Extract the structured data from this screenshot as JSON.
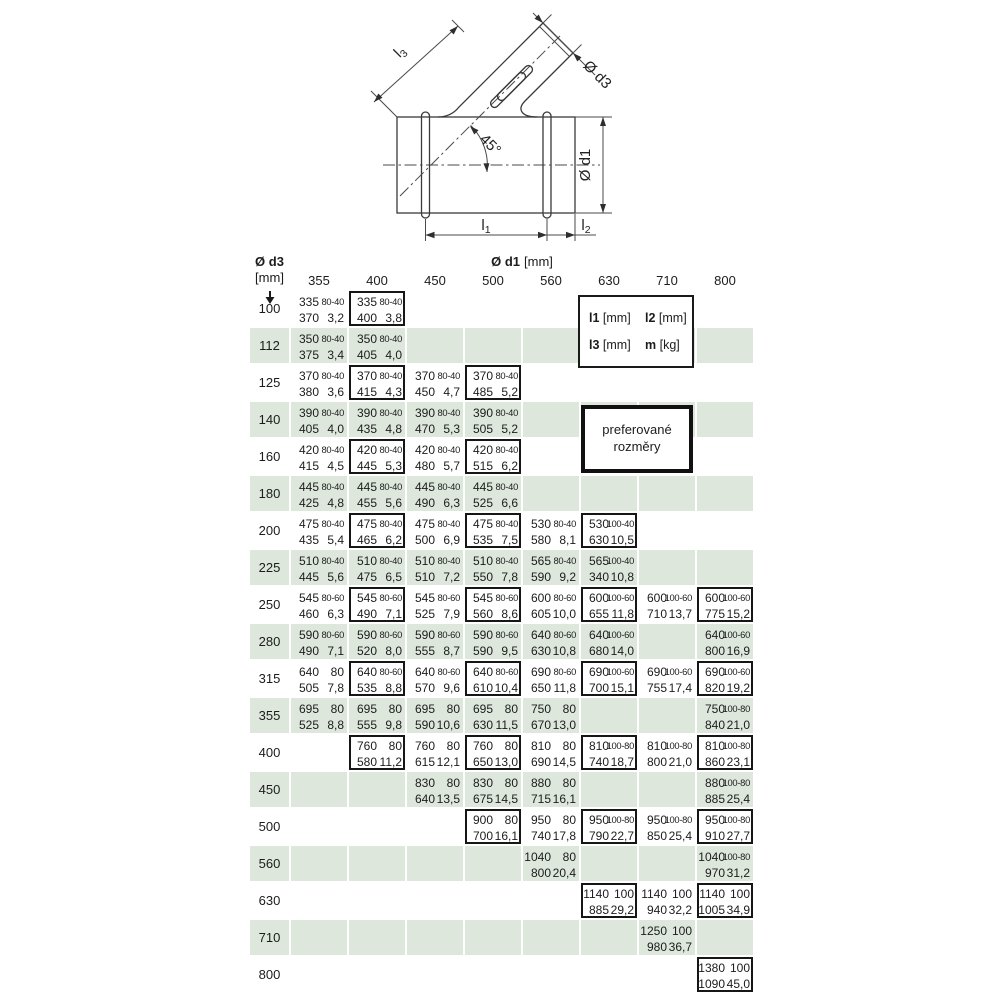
{
  "colors": {
    "row_stripe": "#dde7dc",
    "line": "#3a3a3a",
    "text": "#1c1c1c"
  },
  "drawing": {
    "labels": {
      "l3": {
        "base": "l",
        "sub": "3"
      },
      "d3": "Ø d3",
      "angle": "45°",
      "d1": "Ø d1",
      "l1": {
        "base": "l",
        "sub": "1"
      },
      "l2": {
        "base": "l",
        "sub": "2"
      }
    }
  },
  "table": {
    "corner": {
      "title": "Ø d3",
      "unit": "[mm]"
    },
    "col_header": {
      "title": "Ø d1",
      "unit": "[mm]"
    },
    "columns": [
      "355",
      "400",
      "450",
      "500",
      "560",
      "630",
      "710",
      "800"
    ],
    "legend": {
      "l1": {
        "name": "l1",
        "unit": "[mm]"
      },
      "l2": {
        "name": "l2",
        "unit": "[mm]"
      },
      "l3": {
        "name": "l3",
        "unit": "[mm]"
      },
      "m": {
        "name": "m",
        "unit": "[kg]"
      }
    },
    "preferred_note": {
      "line1": "preferované",
      "line2": "rozměry"
    },
    "rows": [
      {
        "d3": "100",
        "cells": [
          {
            "l1": "335",
            "l2": "80-40",
            "l3": "370",
            "m": "3,2",
            "pref": false
          },
          {
            "l1": "335",
            "l2": "80-40",
            "l3": "400",
            "m": "3,8",
            "pref": true
          },
          null,
          null,
          null,
          null,
          null,
          null
        ]
      },
      {
        "d3": "112",
        "cells": [
          {
            "l1": "350",
            "l2": "80-40",
            "l3": "375",
            "m": "3,4",
            "pref": false
          },
          {
            "l1": "350",
            "l2": "80-40",
            "l3": "405",
            "m": "4,0",
            "pref": false
          },
          null,
          null,
          null,
          null,
          null,
          null
        ]
      },
      {
        "d3": "125",
        "cells": [
          {
            "l1": "370",
            "l2": "80-40",
            "l3": "380",
            "m": "3,6",
            "pref": false
          },
          {
            "l1": "370",
            "l2": "80-40",
            "l3": "415",
            "m": "4,3",
            "pref": true
          },
          {
            "l1": "370",
            "l2": "80-40",
            "l3": "450",
            "m": "4,7",
            "pref": false
          },
          {
            "l1": "370",
            "l2": "80-40",
            "l3": "485",
            "m": "5,2",
            "pref": true
          },
          null,
          null,
          null,
          null
        ]
      },
      {
        "d3": "140",
        "cells": [
          {
            "l1": "390",
            "l2": "80-40",
            "l3": "405",
            "m": "4,0",
            "pref": false
          },
          {
            "l1": "390",
            "l2": "80-40",
            "l3": "435",
            "m": "4,8",
            "pref": false
          },
          {
            "l1": "390",
            "l2": "80-40",
            "l3": "470",
            "m": "5,3",
            "pref": false
          },
          {
            "l1": "390",
            "l2": "80-40",
            "l3": "505",
            "m": "5,2",
            "pref": false
          },
          null,
          null,
          null,
          null
        ]
      },
      {
        "d3": "160",
        "cells": [
          {
            "l1": "420",
            "l2": "80-40",
            "l3": "415",
            "m": "4,5",
            "pref": false
          },
          {
            "l1": "420",
            "l2": "80-40",
            "l3": "445",
            "m": "5,3",
            "pref": true
          },
          {
            "l1": "420",
            "l2": "80-40",
            "l3": "480",
            "m": "5,7",
            "pref": false
          },
          {
            "l1": "420",
            "l2": "80-40",
            "l3": "515",
            "m": "6,2",
            "pref": true
          },
          null,
          null,
          null,
          null
        ]
      },
      {
        "d3": "180",
        "cells": [
          {
            "l1": "445",
            "l2": "80-40",
            "l3": "425",
            "m": "4,8",
            "pref": false
          },
          {
            "l1": "445",
            "l2": "80-40",
            "l3": "455",
            "m": "5,6",
            "pref": false
          },
          {
            "l1": "445",
            "l2": "80-40",
            "l3": "490",
            "m": "6,3",
            "pref": false
          },
          {
            "l1": "445",
            "l2": "80-40",
            "l3": "525",
            "m": "6,6",
            "pref": false
          },
          null,
          null,
          null,
          null
        ]
      },
      {
        "d3": "200",
        "cells": [
          {
            "l1": "475",
            "l2": "80-40",
            "l3": "435",
            "m": "5,4",
            "pref": false
          },
          {
            "l1": "475",
            "l2": "80-40",
            "l3": "465",
            "m": "6,2",
            "pref": true
          },
          {
            "l1": "475",
            "l2": "80-40",
            "l3": "500",
            "m": "6,9",
            "pref": false
          },
          {
            "l1": "475",
            "l2": "80-40",
            "l3": "535",
            "m": "7,5",
            "pref": true
          },
          {
            "l1": "530",
            "l2": "80-40",
            "l3": "580",
            "m": "8,1",
            "pref": false
          },
          {
            "l1": "530",
            "l2": "100-40",
            "l3": "630",
            "m": "10,5",
            "pref": true
          },
          null,
          null
        ]
      },
      {
        "d3": "225",
        "cells": [
          {
            "l1": "510",
            "l2": "80-40",
            "l3": "445",
            "m": "5,6",
            "pref": false
          },
          {
            "l1": "510",
            "l2": "80-40",
            "l3": "475",
            "m": "6,5",
            "pref": false
          },
          {
            "l1": "510",
            "l2": "80-40",
            "l3": "510",
            "m": "7,2",
            "pref": false
          },
          {
            "l1": "510",
            "l2": "80-40",
            "l3": "550",
            "m": "7,8",
            "pref": false
          },
          {
            "l1": "565",
            "l2": "80-40",
            "l3": "590",
            "m": "9,2",
            "pref": false
          },
          {
            "l1": "565",
            "l2": "100-40",
            "l3": "340",
            "m": "10,8",
            "pref": false
          },
          null,
          null
        ]
      },
      {
        "d3": "250",
        "cells": [
          {
            "l1": "545",
            "l2": "80-60",
            "l3": "460",
            "m": "6,3",
            "pref": false
          },
          {
            "l1": "545",
            "l2": "80-60",
            "l3": "490",
            "m": "7,1",
            "pref": true
          },
          {
            "l1": "545",
            "l2": "80-60",
            "l3": "525",
            "m": "7,9",
            "pref": false
          },
          {
            "l1": "545",
            "l2": "80-60",
            "l3": "560",
            "m": "8,6",
            "pref": true
          },
          {
            "l1": "600",
            "l2": "80-60",
            "l3": "605",
            "m": "10,0",
            "pref": false
          },
          {
            "l1": "600",
            "l2": "100-60",
            "l3": "655",
            "m": "11,8",
            "pref": true
          },
          {
            "l1": "600",
            "l2": "100-60",
            "l3": "710",
            "m": "13,7",
            "pref": false
          },
          {
            "l1": "600",
            "l2": "100-60",
            "l3": "775",
            "m": "15,2",
            "pref": true
          }
        ]
      },
      {
        "d3": "280",
        "cells": [
          {
            "l1": "590",
            "l2": "80-60",
            "l3": "490",
            "m": "7,1",
            "pref": false
          },
          {
            "l1": "590",
            "l2": "80-60",
            "l3": "520",
            "m": "8,0",
            "pref": false
          },
          {
            "l1": "590",
            "l2": "80-60",
            "l3": "555",
            "m": "8,7",
            "pref": false
          },
          {
            "l1": "590",
            "l2": "80-60",
            "l3": "590",
            "m": "9,5",
            "pref": false
          },
          {
            "l1": "640",
            "l2": "80-60",
            "l3": "630",
            "m": "10,8",
            "pref": false
          },
          {
            "l1": "640",
            "l2": "100-60",
            "l3": "680",
            "m": "14,0",
            "pref": false
          },
          null,
          {
            "l1": "640",
            "l2": "100-60",
            "l3": "800",
            "m": "16,9",
            "pref": false
          }
        ]
      },
      {
        "d3": "315",
        "cells": [
          {
            "l1": "640",
            "l2": "80",
            "l3": "505",
            "m": "7,8",
            "pref": false
          },
          {
            "l1": "640",
            "l2": "80-60",
            "l3": "535",
            "m": "8,8",
            "pref": true
          },
          {
            "l1": "640",
            "l2": "80-60",
            "l3": "570",
            "m": "9,6",
            "pref": false
          },
          {
            "l1": "640",
            "l2": "80-60",
            "l3": "610",
            "m": "10,4",
            "pref": true
          },
          {
            "l1": "690",
            "l2": "80-60",
            "l3": "650",
            "m": "11,8",
            "pref": false
          },
          {
            "l1": "690",
            "l2": "100-60",
            "l3": "700",
            "m": "15,1",
            "pref": true
          },
          {
            "l1": "690",
            "l2": "100-60",
            "l3": "755",
            "m": "17,4",
            "pref": false
          },
          {
            "l1": "690",
            "l2": "100-60",
            "l3": "820",
            "m": "19,2",
            "pref": true
          }
        ]
      },
      {
        "d3": "355",
        "cells": [
          {
            "l1": "695",
            "l2": "80",
            "l3": "525",
            "m": "8,8",
            "pref": false
          },
          {
            "l1": "695",
            "l2": "80",
            "l3": "555",
            "m": "9,8",
            "pref": false
          },
          {
            "l1": "695",
            "l2": "80",
            "l3": "590",
            "m": "10,6",
            "pref": false
          },
          {
            "l1": "695",
            "l2": "80",
            "l3": "630",
            "m": "11,5",
            "pref": false
          },
          {
            "l1": "750",
            "l2": "80",
            "l3": "670",
            "m": "13,0",
            "pref": false
          },
          null,
          null,
          {
            "l1": "750",
            "l2": "100-80",
            "l3": "840",
            "m": "21,0",
            "pref": false
          }
        ]
      },
      {
        "d3": "400",
        "cells": [
          null,
          {
            "l1": "760",
            "l2": "80",
            "l3": "580",
            "m": "11,2",
            "pref": true
          },
          {
            "l1": "760",
            "l2": "80",
            "l3": "615",
            "m": "12,1",
            "pref": false
          },
          {
            "l1": "760",
            "l2": "80",
            "l3": "650",
            "m": "13,0",
            "pref": true
          },
          {
            "l1": "810",
            "l2": "80",
            "l3": "690",
            "m": "14,5",
            "pref": false
          },
          {
            "l1": "810",
            "l2": "100-80",
            "l3": "740",
            "m": "18,7",
            "pref": true
          },
          {
            "l1": "810",
            "l2": "100-80",
            "l3": "800",
            "m": "21,0",
            "pref": false
          },
          {
            "l1": "810",
            "l2": "100-80",
            "l3": "860",
            "m": "23,1",
            "pref": true
          }
        ]
      },
      {
        "d3": "450",
        "cells": [
          null,
          null,
          {
            "l1": "830",
            "l2": "80",
            "l3": "640",
            "m": "13,5",
            "pref": false
          },
          {
            "l1": "830",
            "l2": "80",
            "l3": "675",
            "m": "14,5",
            "pref": false
          },
          {
            "l1": "880",
            "l2": "80",
            "l3": "715",
            "m": "16,1",
            "pref": false
          },
          null,
          null,
          {
            "l1": "880",
            "l2": "100-80",
            "l3": "885",
            "m": "25,4",
            "pref": false
          }
        ]
      },
      {
        "d3": "500",
        "cells": [
          null,
          null,
          null,
          {
            "l1": "900",
            "l2": "80",
            "l3": "700",
            "m": "16,1",
            "pref": true
          },
          {
            "l1": "950",
            "l2": "80",
            "l3": "740",
            "m": "17,8",
            "pref": false
          },
          {
            "l1": "950",
            "l2": "100-80",
            "l3": "790",
            "m": "22,7",
            "pref": true
          },
          {
            "l1": "950",
            "l2": "100-80",
            "l3": "850",
            "m": "25,4",
            "pref": false
          },
          {
            "l1": "950",
            "l2": "100-80",
            "l3": "910",
            "m": "27,7",
            "pref": true
          }
        ]
      },
      {
        "d3": "560",
        "cells": [
          null,
          null,
          null,
          null,
          {
            "l1": "1040",
            "l2": "80",
            "l3": "800",
            "m": "20,4",
            "pref": false
          },
          null,
          null,
          {
            "l1": "1040",
            "l2": "100-80",
            "l3": "970",
            "m": "31,2",
            "pref": false
          }
        ]
      },
      {
        "d3": "630",
        "cells": [
          null,
          null,
          null,
          null,
          null,
          {
            "l1": "1140",
            "l2": "100",
            "l3": "885",
            "m": "29,2",
            "pref": true
          },
          {
            "l1": "1140",
            "l2": "100",
            "l3": "940",
            "m": "32,2",
            "pref": false
          },
          {
            "l1": "1140",
            "l2": "100",
            "l3": "1005",
            "m": "34,9",
            "pref": true
          }
        ]
      },
      {
        "d3": "710",
        "cells": [
          null,
          null,
          null,
          null,
          null,
          null,
          {
            "l1": "1250",
            "l2": "100",
            "l3": "980",
            "m": "36,7",
            "pref": false
          },
          null
        ]
      },
      {
        "d3": "800",
        "cells": [
          null,
          null,
          null,
          null,
          null,
          null,
          null,
          {
            "l1": "1380",
            "l2": "100",
            "l3": "1090",
            "m": "45,0",
            "pref": true
          }
        ]
      }
    ]
  }
}
